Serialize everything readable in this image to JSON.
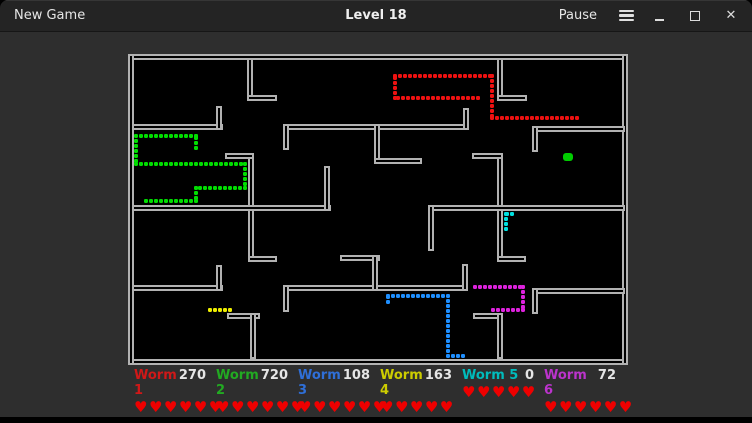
{
  "titlebar": {
    "new_game_label": "New Game",
    "title": "Level 18",
    "pause_label": "Pause"
  },
  "colors": {
    "titlebar_bg": "#242424",
    "window_bg": "#2e2e2e",
    "board_bg": "#000000",
    "wall": "#b2b2b2",
    "heart": "#ee0000",
    "score_text": "#e6e6e6"
  },
  "board": {
    "frame": [
      [
        0,
        0,
        500,
        6
      ],
      [
        0,
        305,
        500,
        6
      ],
      [
        0,
        0,
        6,
        311
      ],
      [
        494,
        0,
        6,
        311
      ]
    ],
    "walls": [
      [
        119,
        4,
        6,
        43
      ],
      [
        119,
        41,
        30,
        6
      ],
      [
        369,
        4,
        6,
        43
      ],
      [
        369,
        41,
        30,
        6
      ],
      [
        4,
        70,
        91,
        6
      ],
      [
        88,
        52,
        6,
        24
      ],
      [
        155,
        70,
        186,
        6
      ],
      [
        155,
        70,
        6,
        26
      ],
      [
        335,
        54,
        6,
        22
      ],
      [
        404,
        72,
        93,
        6
      ],
      [
        404,
        72,
        6,
        26
      ],
      [
        246,
        70,
        6,
        40
      ],
      [
        246,
        104,
        48,
        6
      ],
      [
        369,
        99,
        6,
        109
      ],
      [
        344,
        99,
        31,
        6
      ],
      [
        369,
        202,
        29,
        6
      ],
      [
        120,
        99,
        6,
        109
      ],
      [
        97,
        99,
        29,
        6
      ],
      [
        120,
        202,
        29,
        6
      ],
      [
        4,
        151,
        199,
        6
      ],
      [
        196,
        112,
        6,
        45
      ],
      [
        300,
        151,
        197,
        6
      ],
      [
        300,
        151,
        6,
        46
      ],
      [
        4,
        231,
        91,
        6
      ],
      [
        88,
        211,
        6,
        26
      ],
      [
        155,
        231,
        185,
        6
      ],
      [
        155,
        231,
        6,
        27
      ],
      [
        334,
        210,
        6,
        27
      ],
      [
        404,
        234,
        93,
        6
      ],
      [
        404,
        234,
        6,
        26
      ],
      [
        212,
        201,
        40,
        6
      ],
      [
        244,
        201,
        6,
        36
      ],
      [
        99,
        259,
        33,
        6
      ],
      [
        122,
        259,
        6,
        46
      ],
      [
        345,
        259,
        30,
        6
      ],
      [
        369,
        259,
        6,
        46
      ]
    ],
    "worms": [
      {
        "id": "worm-1",
        "dot_color": "#ee1111",
        "path": [
          [
            350,
            44
          ],
          [
            267,
            44
          ],
          [
            267,
            22
          ],
          [
            364,
            22
          ],
          [
            364,
            64
          ],
          [
            449,
            64
          ]
        ]
      },
      {
        "id": "worm-2",
        "dot_color": "#00dd00",
        "path": [
          [
            68,
            94
          ],
          [
            68,
            82
          ],
          [
            8,
            82
          ],
          [
            8,
            110
          ],
          [
            117,
            110
          ],
          [
            117,
            134
          ],
          [
            68,
            134
          ],
          [
            68,
            147
          ],
          [
            17,
            147
          ]
        ]
      },
      {
        "id": "worm-3",
        "dot_color": "#1e8fff",
        "path": [
          [
            260,
            248
          ],
          [
            260,
            242
          ],
          [
            320,
            242
          ],
          [
            320,
            302
          ],
          [
            339,
            302
          ]
        ]
      },
      {
        "id": "worm-4",
        "dot_color": "#eeee00",
        "path": [
          [
            82,
            256
          ],
          [
            103,
            256
          ]
        ]
      },
      {
        "id": "worm-5",
        "dot_color": "#00e0e0",
        "path": [
          [
            384,
            160
          ],
          [
            378,
            160
          ],
          [
            378,
            175
          ]
        ]
      },
      {
        "id": "worm-6",
        "dot_color": "#dd22dd",
        "path": [
          [
            347,
            233
          ],
          [
            395,
            233
          ],
          [
            395,
            256
          ],
          [
            362,
            256
          ]
        ]
      }
    ],
    "food": {
      "x": 435,
      "y": 99,
      "w": 10,
      "h": 8,
      "color": "#00cc00"
    }
  },
  "scoreboard": {
    "heart_icon": "♥",
    "players": [
      {
        "name": "Worm 1",
        "score": "270",
        "lives": 6,
        "color": "#d01818"
      },
      {
        "name": "Worm 2",
        "score": "720",
        "lives": 6,
        "color": "#22aa22"
      },
      {
        "name": "Worm 3",
        "score": "108",
        "lives": 6,
        "color": "#2f6fd8"
      },
      {
        "name": "Worm 4",
        "score": "163",
        "lives": 5,
        "color": "#cccc00"
      },
      {
        "name": "Worm 5",
        "score": "0",
        "lives": 5,
        "color": "#00bcbc"
      },
      {
        "name": "Worm 6",
        "score": "72",
        "lives": 6,
        "color": "#bb33cc"
      }
    ]
  }
}
